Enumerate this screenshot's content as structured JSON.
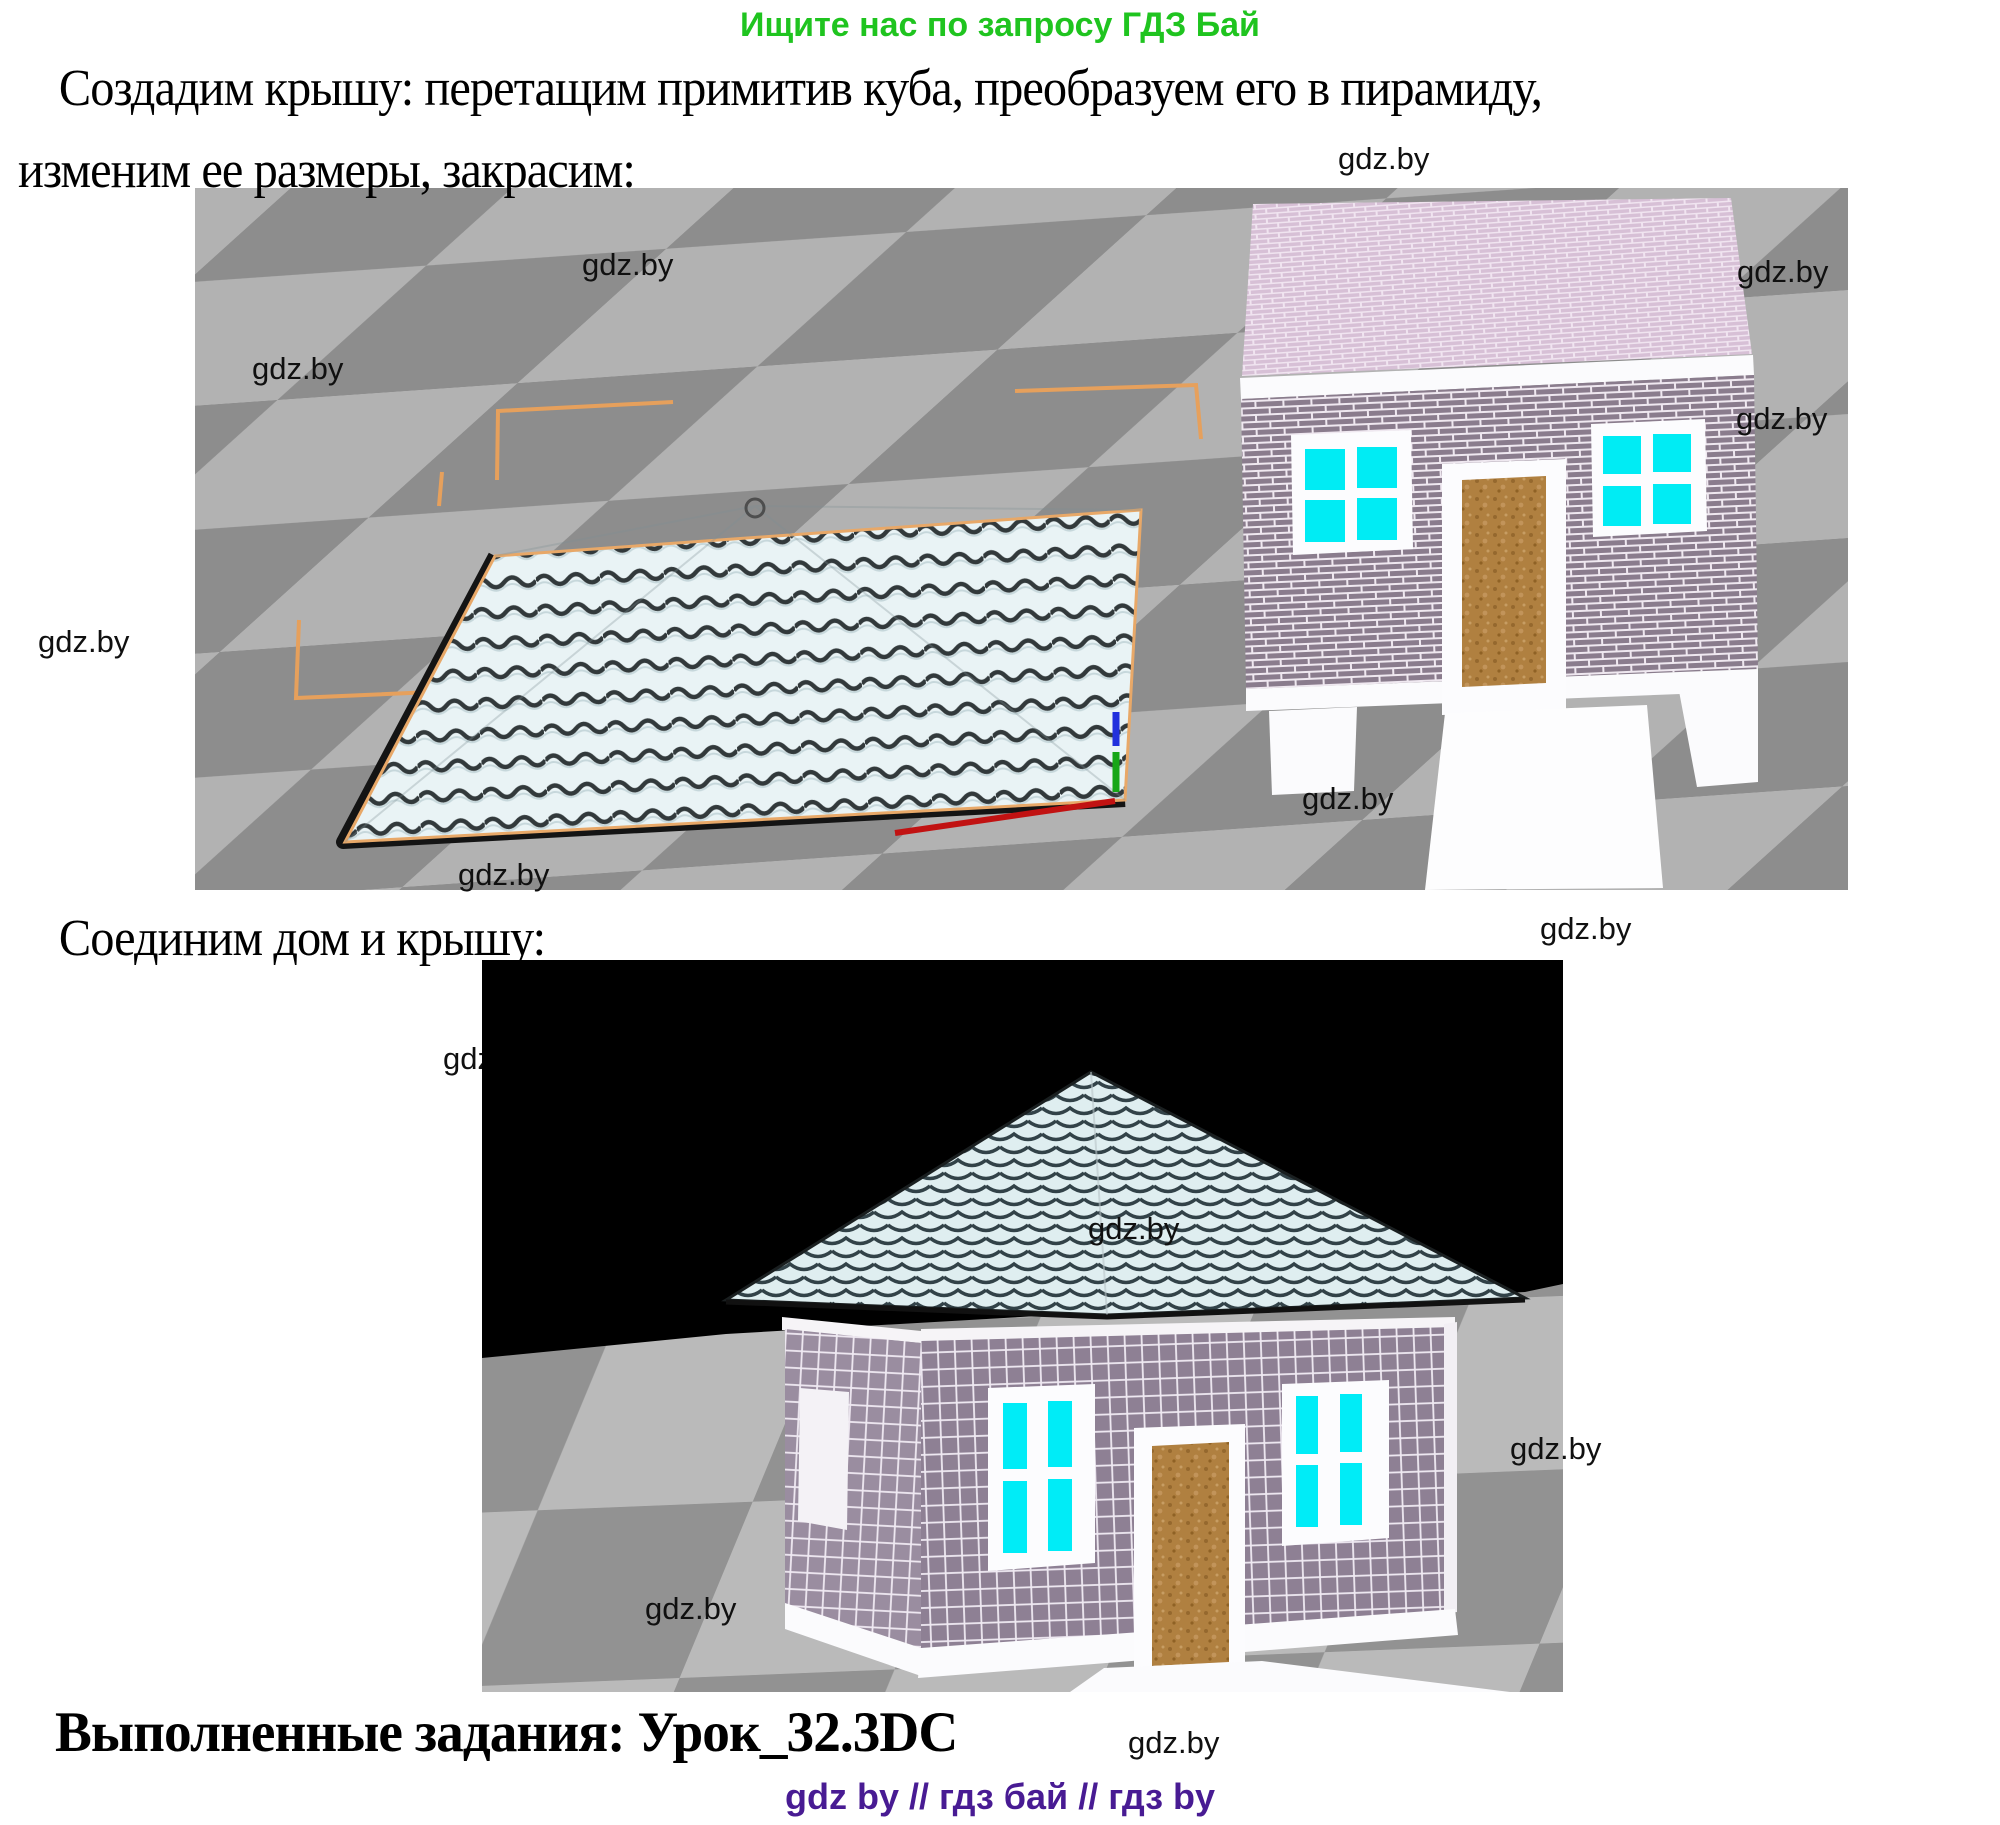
{
  "header": {
    "promo": "Ищите нас по запросу ГДЗ Бай"
  },
  "steps": {
    "step1_line1": "Создадим крышу: перетащим примитив куба, преобразуем его в пирамиду,",
    "step1_line2": "изменим ее размеры, закрасим:",
    "step2": "Соединим дом и крышу:"
  },
  "footer": {
    "completed_line": "Выполненные задания: Урок_32.3DC",
    "links_line": "gdz by  //  гдз бай  //  гдз by"
  },
  "watermarks": {
    "full_text": "gdz.by",
    "partial_text": "gdz"
  },
  "scenes": {
    "scene1_caption": "",
    "scene2_caption": ""
  },
  "colors": {
    "promo_green": "#1fc41f",
    "footer_purple": "#481b93",
    "watermark_black": "#101010",
    "floor_light_gray": "#b2b2b2",
    "floor_dark_gray": "#8d8d8d",
    "wall_brick_purple": "#8a7c8d",
    "house_top_pink": "#d7c0d6",
    "window_cyan": "#00ecf4",
    "door_brown": "#b08040",
    "selection_orange": "#e6a05c",
    "roof_shingle_light": "#e9f3f5",
    "scene2_sky": "#000000"
  }
}
